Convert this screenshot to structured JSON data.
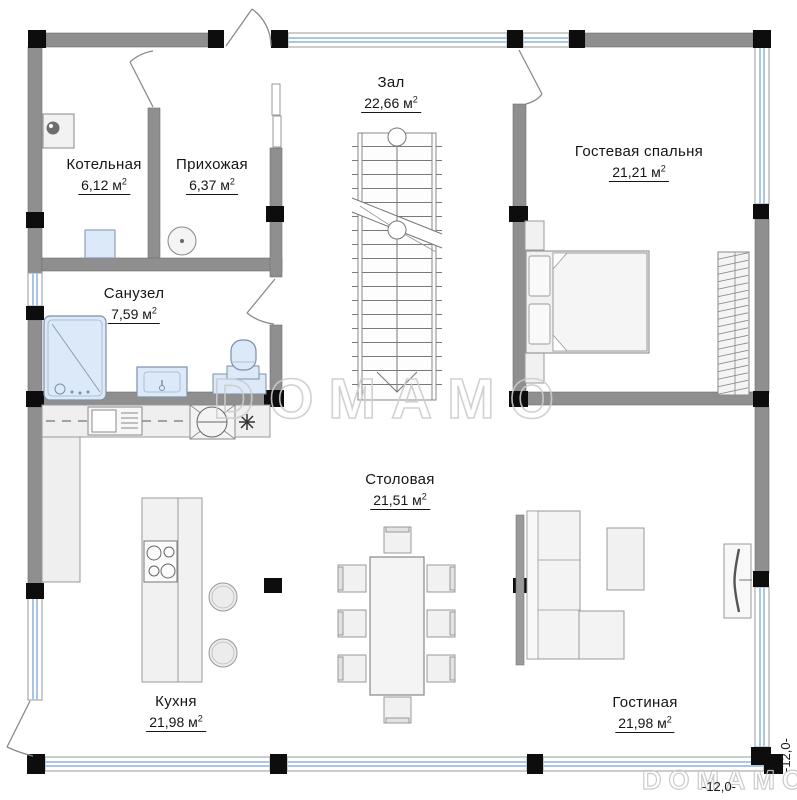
{
  "rooms": [
    {
      "name": "Котельная",
      "area": "6,12 м",
      "sup": "2"
    },
    {
      "name": "Прихожая",
      "area": "6,37 м",
      "sup": "2"
    },
    {
      "name": "Зал",
      "area": "22,66 м",
      "sup": "2"
    },
    {
      "name": "Гостевая спальня",
      "area": "21,21 м",
      "sup": "2"
    },
    {
      "name": "Санузел",
      "area": "7,59 м",
      "sup": "2"
    },
    {
      "name": "Столовая",
      "area": "21,51 м",
      "sup": "2"
    },
    {
      "name": "Кухня",
      "area": "21,98 м",
      "sup": "2"
    },
    {
      "name": "Гостиная",
      "area": "21,98 м",
      "sup": "2"
    }
  ],
  "dimensions": {
    "right": "-12,0-",
    "bottom": "-12,0-"
  },
  "watermark": {
    "center": "DOMAMO",
    "corner": "DOMAMO"
  },
  "colors": {
    "wall_gray": "#8f8f8f",
    "column_black": "#0d0d0d",
    "window_glazing": "#a9c6e2",
    "fixture_blue": "#dbe9f8",
    "furniture_fill": "#f1f1f1",
    "watermark_gray": "#cdcdcd"
  }
}
